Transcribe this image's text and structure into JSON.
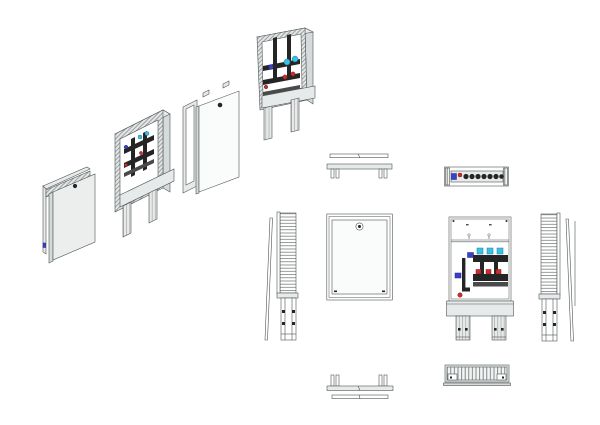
{
  "drawing": {
    "title": "Wall-mounted heating manifold cabinet - multi-view technical drawing",
    "background": "#ffffff",
    "colors": {
      "line": "#4f5454",
      "panel-light": "#e7eaea",
      "panel-mid": "#d5dada",
      "near-white": "#fafbfb",
      "white": "#ffffff",
      "dark": "#252525",
      "dark2": "#4a4a4a",
      "cyan": "#3cc1e6",
      "blue": "#3b3fce",
      "red": "#cf2d2d"
    },
    "views": {
      "iso_cabinet_closed": {
        "label": "Isometric view - cabinet with door closed"
      },
      "iso_cabinet_open": {
        "label": "Isometric view - open cabinet with manifold"
      },
      "iso_door_panel": {
        "label": "Isometric view - door and mounting frame"
      },
      "iso_cabinet_open_right": {
        "label": "Isometric view - open cabinet, right-hand angle"
      },
      "top_closed": {
        "label": "Top view - cabinet closed"
      },
      "top_open": {
        "label": "Top view - manifold in cabinet"
      },
      "front_closed": {
        "label": "Front view - cabinet closed with lock"
      },
      "front_open": {
        "label": "Front view - open cabinet with manifold"
      },
      "side_left": {
        "label": "Left side view - rail and leg"
      },
      "side_right": {
        "label": "Right side view - rail and leg"
      },
      "bottom_closed": {
        "label": "Bottom view - cabinet closed"
      },
      "bottom_open": {
        "label": "Bottom view - vent grille"
      }
    }
  }
}
